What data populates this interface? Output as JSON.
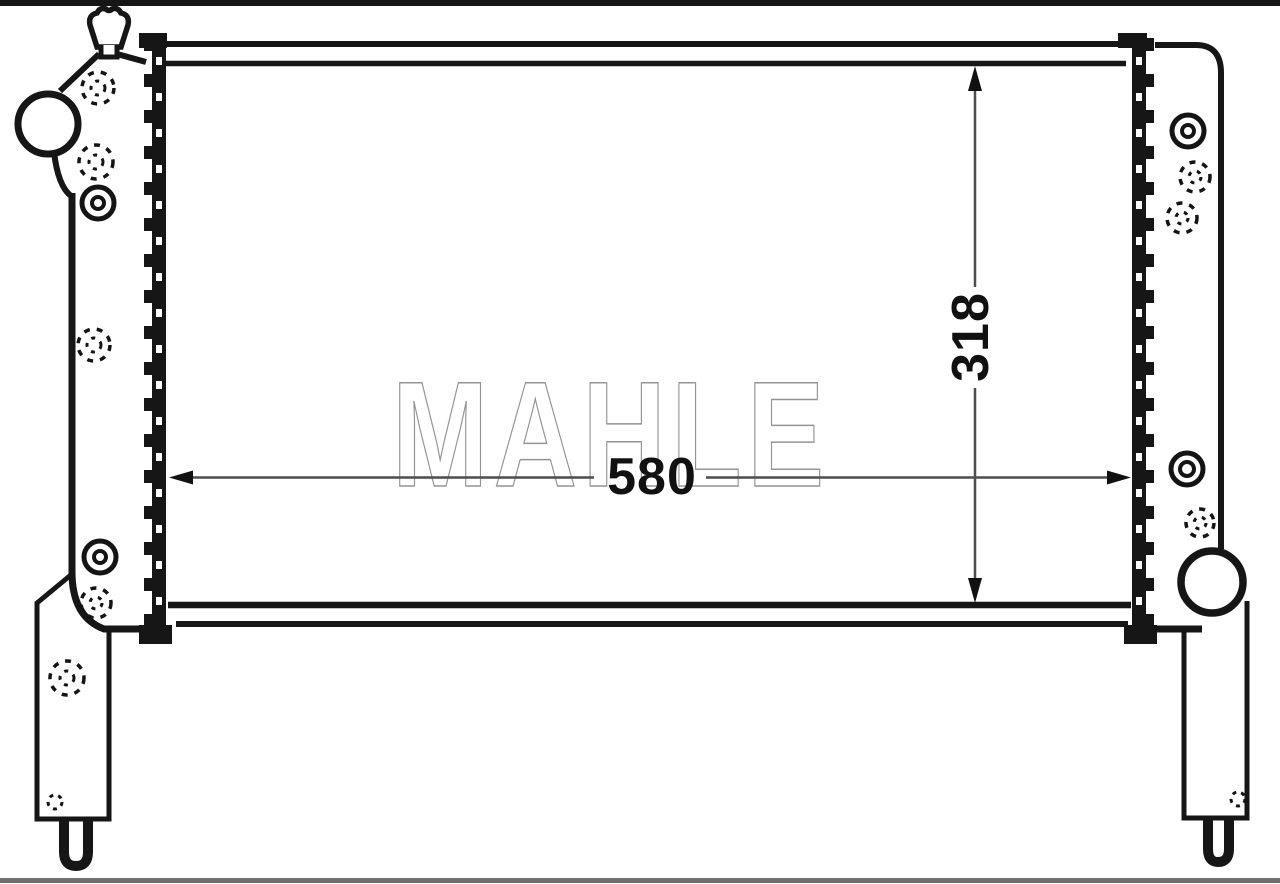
{
  "watermark": {
    "text": "MAHLE"
  },
  "dimensions": {
    "core_width": {
      "value": "580",
      "orientation": "horizontal"
    },
    "core_height": {
      "value": "318",
      "orientation": "vertical"
    }
  },
  "colors": {
    "background": "#ffffff",
    "line_art": "#161616",
    "dimension_line": "#4d4d4d",
    "dimension_text": "#111111",
    "watermark_outline": "#949494",
    "top_border": "#161616",
    "bottom_border": "#6f6f6f"
  }
}
